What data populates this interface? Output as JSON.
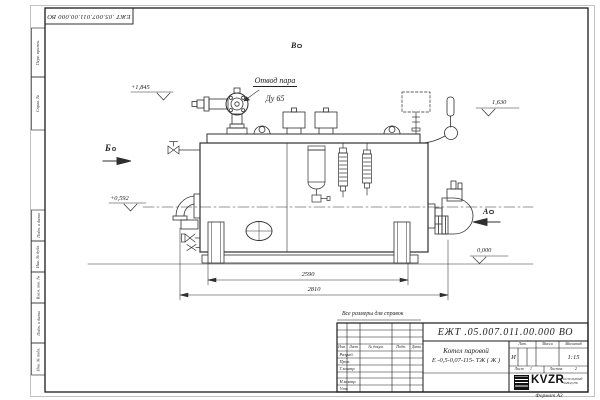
{
  "frame": {
    "top_stamp": "ЕЖТ .05.007.011.00.000  ВО",
    "margin_labels": {
      "perv_primen": "Перв. примен.",
      "sprav_no": "Справ. №",
      "podp_data_1": "Подп. и дата",
      "inv_dubl": "Инв. № дубл.",
      "vzam_inv": "Взам. инв. №",
      "podp_data_2": "Подп. и дата",
      "inv_podl": "Инв. № подл."
    },
    "format_note": "Формат А3"
  },
  "drawing": {
    "callout_line1": "Отвод пара",
    "callout_line2": "Ду 65",
    "elevation_top": "+1,845",
    "elevation_mid": "+0,592",
    "elevation_right": "1,630",
    "elevation_zero": "0,000",
    "view_b": "Б",
    "view_v": "В",
    "view_a": "А",
    "dim_inner": "2590",
    "dim_outer": "2810",
    "ref_note": "Все размеры для справок"
  },
  "title_block": {
    "doc_number": "ЕЖТ .05.007.011.00.000  ВО",
    "product_name": "Котел паровой",
    "product_type": "Е -0,5-0,07-115- ТЖ ( Ж )",
    "col_izm": "Изм.",
    "col_list": "Лист",
    "col_dokum": "№ докум.",
    "col_podp": "Подп.",
    "col_data": "Дата",
    "row_razrab": "Разраб.",
    "row_prov": "Пров.",
    "row_tkontr": "Т.контр.",
    "row_nkontr": "Н.контр.",
    "row_utv": "Утв.",
    "lit_label": "Лит.",
    "lit_value": "И",
    "mass_label": "Масса",
    "scale_label": "Масштаб",
    "scale_value": "1:15",
    "sheet_label": "Лист",
    "sheet_value": "1",
    "sheets_label": "Листов",
    "sheets_value": "2",
    "company_name": "KVZR",
    "company_sub1": "КОТЕЛЬНЫЙ",
    "company_sub2": "ЗАВОД РФ"
  },
  "colors": {
    "line": "#2f2f2f",
    "paper": "#ffffff",
    "logo": "#111111"
  }
}
